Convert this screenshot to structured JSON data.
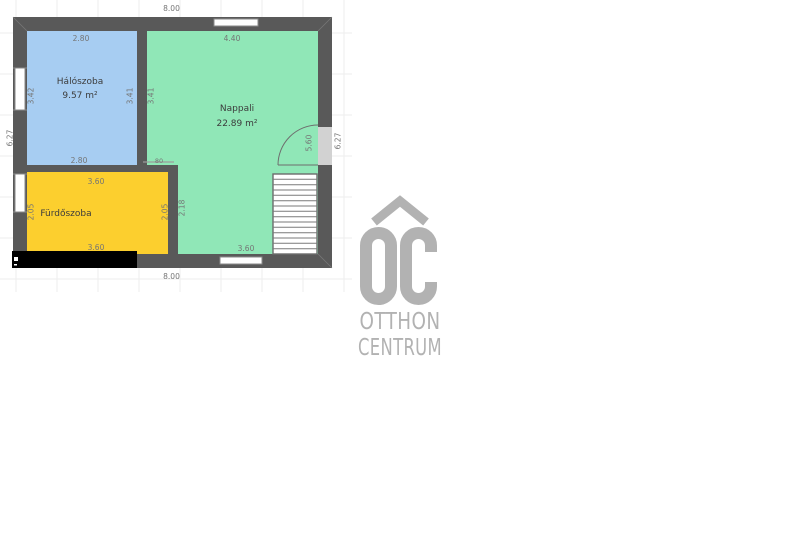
{
  "colors": {
    "wall": "#595959",
    "bedroom": "#a7cdf2",
    "living": "#90e7b7",
    "bath": "#fccf2e",
    "door_gap": "#d2d2d2",
    "grid": "#ededed",
    "dim_text": "#757575",
    "room_text": "#3c3c3c",
    "logo": "#b2b2b2"
  },
  "floorplan": {
    "rooms": {
      "bedroom": {
        "name": "Hálószoba",
        "area": "9.57 m²"
      },
      "living": {
        "name": "Nappali",
        "area": "22.89 m²"
      },
      "bath": {
        "name": "Fürdőszoba"
      }
    },
    "dimensions": {
      "outer_top": "8.00",
      "outer_bottom": "8.00",
      "outer_left": "6.27",
      "outer_right": "6.27",
      "bedroom_top": "2.80",
      "bedroom_bottom": "2.80",
      "bedroom_left": "3.42",
      "bedroom_right": "3.41",
      "living_left_upper": "3.41",
      "living_top": "4.40",
      "living_bottom": "3.60",
      "living_door_side": "5.60",
      "living_left_lower": "2.18",
      "bath_door_opening": "80",
      "bath_top": "3.60",
      "bath_bottom": "3.60",
      "bath_left": "2.05",
      "bath_right": "2.05"
    }
  },
  "logo": {
    "monogram": "OC",
    "line1": "OTTHON",
    "line2": "CENTRUM"
  }
}
